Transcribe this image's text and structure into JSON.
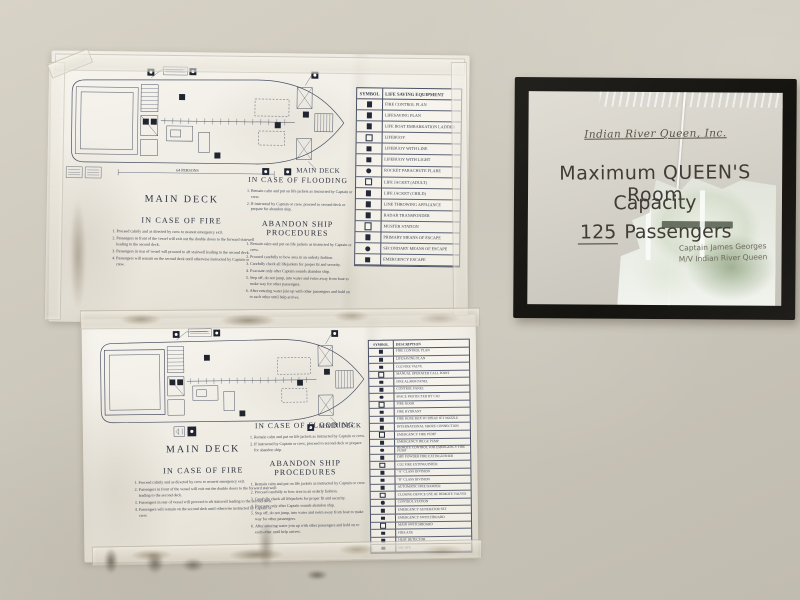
{
  "posters": {
    "top": {
      "plan_label": "MAIN DECK",
      "capacity_note": "64 PERSONS",
      "deck_heading": "MAIN DECK",
      "fire_heading": "IN CASE OF FIRE",
      "fire_items": [
        "Proceed calmly and as directed by crew to nearest emergency exit.",
        "Passengers in front of the vessel will exit out the double doors to the forward stairwell leading to the second deck.",
        "Passengers in rear of vessel will proceed to aft stairwell leading to the second deck.",
        "Passengers will remain on the second deck until otherwise instructed by Captain or crew."
      ],
      "flooding_heading": "IN CASE OF FLOODING",
      "flooding_items": [
        "Remain calm and put on life jackets as instructed by Captain or crew.",
        "If instructed by Captain or crew, proceed to second deck or prepare for abandon ship."
      ],
      "abandon_heading": "ABANDON SHIP PROCEDURES",
      "abandon_items": [
        "Remain calm and put on life jackets as instructed by Captain or crew.",
        "Proceed carefully to bow area in an orderly fashion.",
        "Carefully check all lifejackets for proper fit and security.",
        "Evacuate only after Captain sounds abandon ship.",
        "Step off, do not jump, into water and swim away from boat to make way for other passengers.",
        "After entering water join up with other passengers and hold on to each other until help arrives."
      ],
      "legend": {
        "symbol_header": "SYMBOL",
        "description_header": "LIFE SAVING EQUIPMENT",
        "rows": [
          "FIRE CONTROL PLAN",
          "LIFESAVING PLAN",
          "LIFE BOAT EMBARKATION LADDER",
          "LIFEBUOY",
          "LIFEBUOY WITH LINE",
          "LIFEBUOY WITH LIGHT",
          "ROCKET PARACHUTE FLARE",
          "LIFE JACKET (ADULT)",
          "LIFE JACKET (CHILD)",
          "LINE THROWING APPLIANCE",
          "RADAR TRANSPONDER",
          "MUSTER STATION",
          "PRIMARY MEANS OF ESCAPE",
          "SECONDARY MEANS OF ESCAPE",
          "EMERGENCY ESCAPE"
        ]
      }
    },
    "bottom": {
      "plan_label": "MAIN DECK",
      "capacity_note": "",
      "deck_heading": "MAIN DECK",
      "fire_heading": "IN CASE OF FIRE",
      "fire_items": [
        "Proceed calmly and as directed by crew to nearest emergency exit.",
        "Passengers in front of the vessel will exit out the double doors to the forward stairwell leading to the second deck.",
        "Passengers in rear of vessel will proceed to aft stairwell leading to the second deck.",
        "Passengers will remain on the second deck until otherwise instructed by Captain or crew."
      ],
      "flooding_heading": "IN CASE OF FLOODING",
      "flooding_items": [
        "Remain calm and put on life jackets as instructed by Captain or crew.",
        "If instructed by Captain or crew, proceed to second deck or prepare for abandon ship."
      ],
      "abandon_heading": "ABANDON SHIP PROCEDURES",
      "abandon_items": [
        "Remain calm and put on life jackets as instructed by Captain or crew.",
        "Proceed carefully to bow area in an orderly fashion.",
        "Carefully check all lifejackets for proper fit and security.",
        "Evacuate only after Captain sounds abandon ship.",
        "Step off, do not jump, into water and swim away from boat to make way for other passengers.",
        "After entering water join up with other passengers and hold on to each other until help arrives."
      ],
      "legend": {
        "symbol_header": "SYMBOL",
        "description_header": "DESCRIPTION",
        "rows": [
          "FIRE CONTROL PLAN",
          "LIFESAVING PLAN",
          "CO2 FIRE VALVE",
          "MANUAL OPERATED CALL POINT",
          "FIRE ALARM PANEL",
          "CONTROL PANEL",
          "SPACE PROTECTED BY CO2",
          "FIRE DOOR",
          "FIRE HYDRANT",
          "FIRE HOSE BOX W/ SPRAY JET NOZZLE",
          "INTERNATIONAL SHORE CONNECTION",
          "EMERGENCY FIRE PUMP",
          "EMERGENCY BILGE PUMP",
          "REMOTE CONTROL FOR EMERGENCY FIRE PUMP",
          "DRY POWDER FIRE EXTINGUISHER",
          "CO2 FIRE EXTINGUISHER",
          "\"A\" CLASS DIVISION",
          "\"B\" CLASS DIVISION",
          "AUTOMATIC FIRE DAMPER",
          "CLOSING DEVICE USE OF REMOTE VALVES",
          "CONTROL STATION",
          "EMERGENCY GENERATOR SET",
          "EMERGENCY SWITCHBOARD",
          "MAIN SWITCHBOARD",
          "FIRE AXE",
          "HEAT DETECTOR",
          "ESCAPE"
        ]
      }
    }
  },
  "framed_sign": {
    "company_line": "Indian River Queen, Inc.",
    "title_line1": "Maximum QUEEN'S Room",
    "title_line2": "Capacity",
    "capacity_number": "125",
    "capacity_unit": " Passengers",
    "signature_line1": "Captain James Georges",
    "signature_line2": "M/V Indian River Queen"
  }
}
